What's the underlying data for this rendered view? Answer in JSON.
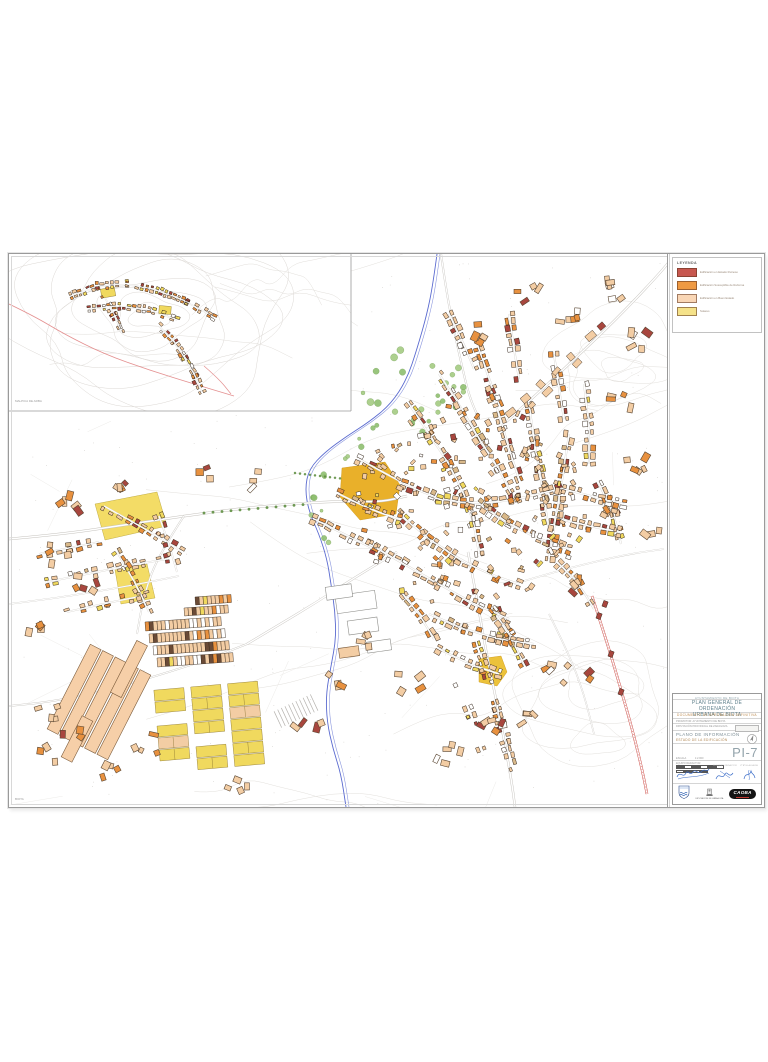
{
  "sheet": {
    "code": "PI-7"
  },
  "legend": {
    "title": "LEYENDA",
    "items": [
      {
        "label": "Edificación en Estado Ruinoso",
        "color": "#c7574f"
      },
      {
        "label": "Edificación Susceptible de Reforma",
        "color": "#ef9a43"
      },
      {
        "label": "Edificación en Buen Estado",
        "color": "#f9d6b5"
      },
      {
        "label": "Solares",
        "color": "#f5e289"
      }
    ]
  },
  "title_block": {
    "municipality": "AYUNTAMIENTO DE BIOTA",
    "title_line1": "PLAN GENERAL DE ORDENACIÓN",
    "title_line2": "URBANA  DE BIOTA",
    "subtitle": "DOCUMENTO DE APROBACIÓN DEFINITIVA",
    "promoter_row": "PROMOTOR:  AYUNTAMIENTO DE BIOTA",
    "org_row": "DIPUTACIÓN PROVINCIAL DE ZARAGOZA",
    "plan_class": "PLANO DE INFORMACIÓN",
    "plan_title": "ESTADO DE LA EDIFICACIÓN",
    "scale_label": "ESCALA",
    "scale_value": "1:2.000",
    "sheet_code": "PI-7",
    "team_label": "EQUIPO REDACTOR",
    "sign_mid_caption": "EL EQUIPO REDACTOR",
    "sign_right_caption": "Vº Bº  EL ALCALDE",
    "dpz_caption": "DIPUTACIÓN DE ZARAGOZA",
    "consultant_logo": "CAOBA"
  },
  "map": {
    "inset_label": "MALPICA DE ARBA",
    "corner_label": "BIOTA",
    "palette": {
      "ruinoso": "#a8463e",
      "reforma": "#e8913f",
      "buen_estado": "#f3cda4",
      "solares": "#f0d95e",
      "tan": "#d9b98a",
      "outline": "#33261a",
      "river": "#5b6bd0",
      "river_light": "#8a96dd",
      "trees": "#8fbf6f",
      "trees_dark": "#5f8f42",
      "contour": "#e3e0dc",
      "road": "#c4c1bc",
      "road_core": "#d6d3ce",
      "road_red": "#cc4a44",
      "pink": "#e49090",
      "field_gold": "#e9b02a",
      "zone_yellow": "#f3dc66",
      "label_gray": "#9a9a9a"
    }
  }
}
